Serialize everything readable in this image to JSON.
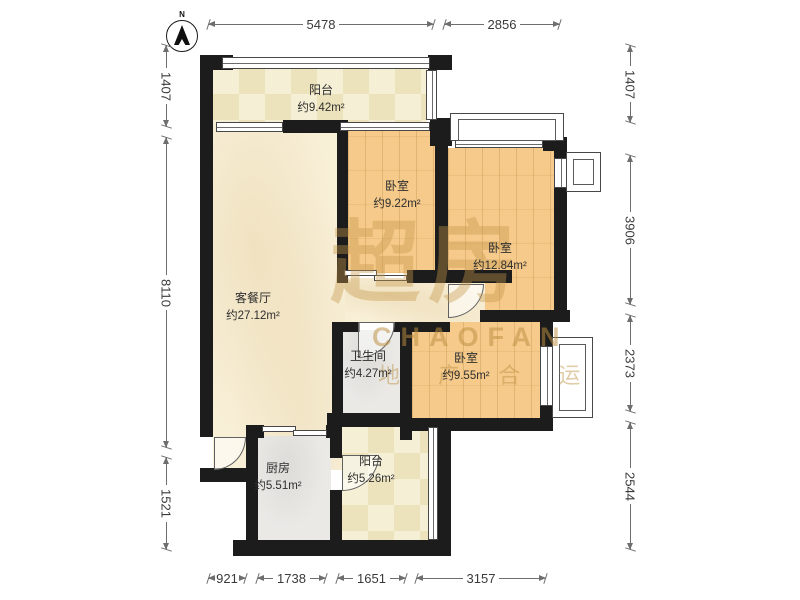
{
  "meta": {
    "north_label": "N"
  },
  "watermark": {
    "brand_cn": "超房",
    "brand_en": "CHAOFAN",
    "tagline": "地 产 合 运"
  },
  "rooms": {
    "balcony_top": {
      "name": "阳台",
      "area": "约9.42m²"
    },
    "living": {
      "name": "客餐厅",
      "area": "约27.12m²"
    },
    "bedroom_small": {
      "name": "卧室",
      "area": "约9.22m²"
    },
    "bedroom_large": {
      "name": "卧室",
      "area": "约12.84m²"
    },
    "bedroom_right": {
      "name": "卧室",
      "area": "约9.55m²"
    },
    "bathroom": {
      "name": "卫生间",
      "area": "约4.27m²"
    },
    "kitchen": {
      "name": "厨房",
      "area": "约5.51m²"
    },
    "balcony_bottom": {
      "name": "阳台",
      "area": "约5.26m²"
    }
  },
  "dimensions": {
    "top": [
      "5478",
      "2856"
    ],
    "bottom": [
      "921",
      "1738",
      "1651",
      "3157"
    ],
    "left": [
      "1407",
      "8110",
      "1521"
    ],
    "right": [
      "1407",
      "3906",
      "2373",
      "2544"
    ]
  },
  "colors": {
    "wall": "#1c1c1c",
    "wood_floor": "#f5ca8a",
    "tile_floor": "#f0e8c8",
    "living_floor": "#f8efd7",
    "wet_floor": "#eae9e6",
    "watermark": "#c69a4a",
    "dimension_text": "#3a3a3a"
  }
}
